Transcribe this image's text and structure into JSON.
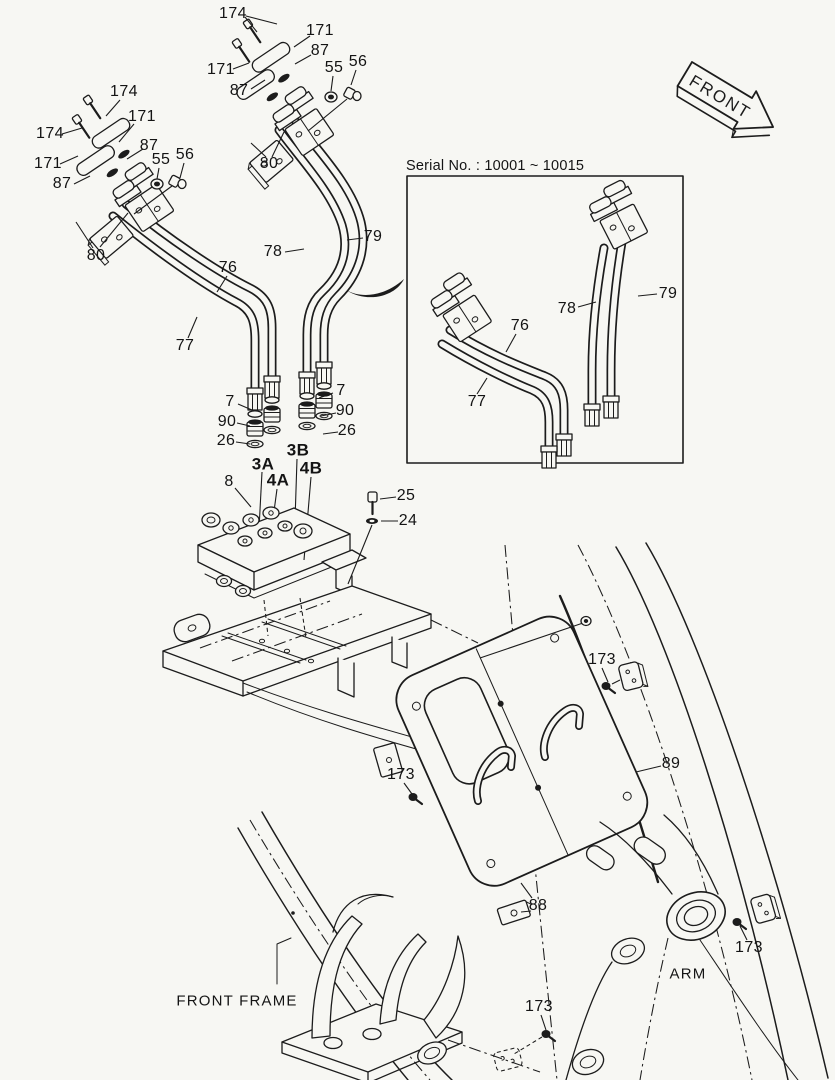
{
  "figure": {
    "background": "#f7f7f3",
    "ink": "#1c1c1c",
    "type": "exploded-parts-diagram"
  },
  "front_arrow": {
    "label": "FRONT"
  },
  "serial_box": {
    "title": "Serial No. : 10001 ~ 10015"
  },
  "callouts": [
    {
      "label": "174",
      "x": 124,
      "y": 92,
      "kind": "part"
    },
    {
      "label": "174",
      "x": 50,
      "y": 134,
      "kind": "part"
    },
    {
      "label": "171",
      "x": 142,
      "y": 117,
      "kind": "part"
    },
    {
      "label": "171",
      "x": 48,
      "y": 164,
      "kind": "part"
    },
    {
      "label": "87",
      "x": 149,
      "y": 146,
      "kind": "part"
    },
    {
      "label": "87",
      "x": 62,
      "y": 184,
      "kind": "part"
    },
    {
      "label": "55",
      "x": 161,
      "y": 160,
      "kind": "part"
    },
    {
      "label": "56",
      "x": 185,
      "y": 155,
      "kind": "part"
    },
    {
      "label": "80",
      "x": 96,
      "y": 256,
      "kind": "part"
    },
    {
      "label": "174",
      "x": 233,
      "y": 14,
      "kind": "part"
    },
    {
      "label": "171",
      "x": 320,
      "y": 31,
      "kind": "part"
    },
    {
      "label": "87",
      "x": 320,
      "y": 51,
      "kind": "part"
    },
    {
      "label": "171",
      "x": 221,
      "y": 70,
      "kind": "part"
    },
    {
      "label": "87",
      "x": 239,
      "y": 91,
      "kind": "part"
    },
    {
      "label": "55",
      "x": 334,
      "y": 68,
      "kind": "part"
    },
    {
      "label": "56",
      "x": 358,
      "y": 62,
      "kind": "part"
    },
    {
      "label": "80",
      "x": 269,
      "y": 164,
      "kind": "part"
    },
    {
      "label": "76",
      "x": 228,
      "y": 268,
      "kind": "part"
    },
    {
      "label": "77",
      "x": 185,
      "y": 346,
      "kind": "part"
    },
    {
      "label": "78",
      "x": 273,
      "y": 252,
      "kind": "part"
    },
    {
      "label": "79",
      "x": 373,
      "y": 237,
      "kind": "part"
    },
    {
      "label": "76",
      "x": 520,
      "y": 326,
      "kind": "part"
    },
    {
      "label": "77",
      "x": 477,
      "y": 402,
      "kind": "part"
    },
    {
      "label": "78",
      "x": 567,
      "y": 309,
      "kind": "part"
    },
    {
      "label": "79",
      "x": 668,
      "y": 294,
      "kind": "part"
    },
    {
      "label": "7",
      "x": 230,
      "y": 402,
      "kind": "part"
    },
    {
      "label": "90",
      "x": 227,
      "y": 422,
      "kind": "part"
    },
    {
      "label": "26",
      "x": 226,
      "y": 441,
      "kind": "part"
    },
    {
      "label": "7",
      "x": 341,
      "y": 391,
      "kind": "part"
    },
    {
      "label": "90",
      "x": 345,
      "y": 411,
      "kind": "part"
    },
    {
      "label": "26",
      "x": 347,
      "y": 431,
      "kind": "part"
    },
    {
      "label": "3A",
      "x": 263,
      "y": 464,
      "kind": "port"
    },
    {
      "label": "3B",
      "x": 298,
      "y": 450,
      "kind": "port"
    },
    {
      "label": "4A",
      "x": 278,
      "y": 480,
      "kind": "port"
    },
    {
      "label": "4B",
      "x": 311,
      "y": 468,
      "kind": "port"
    },
    {
      "label": "8",
      "x": 229,
      "y": 482,
      "kind": "part"
    },
    {
      "label": "25",
      "x": 406,
      "y": 496,
      "kind": "part"
    },
    {
      "label": "24",
      "x": 408,
      "y": 521,
      "kind": "part"
    },
    {
      "label": "173",
      "x": 602,
      "y": 660,
      "kind": "part"
    },
    {
      "label": "173",
      "x": 401,
      "y": 775,
      "kind": "part"
    },
    {
      "label": "89",
      "x": 671,
      "y": 764,
      "kind": "part"
    },
    {
      "label": "88",
      "x": 538,
      "y": 906,
      "kind": "part"
    },
    {
      "label": "173",
      "x": 749,
      "y": 948,
      "kind": "part"
    },
    {
      "label": "173",
      "x": 539,
      "y": 1007,
      "kind": "part"
    },
    {
      "label": "ARM",
      "x": 688,
      "y": 974,
      "kind": "area"
    },
    {
      "label": "FRONT FRAME",
      "x": 237,
      "y": 1001,
      "kind": "area"
    }
  ]
}
